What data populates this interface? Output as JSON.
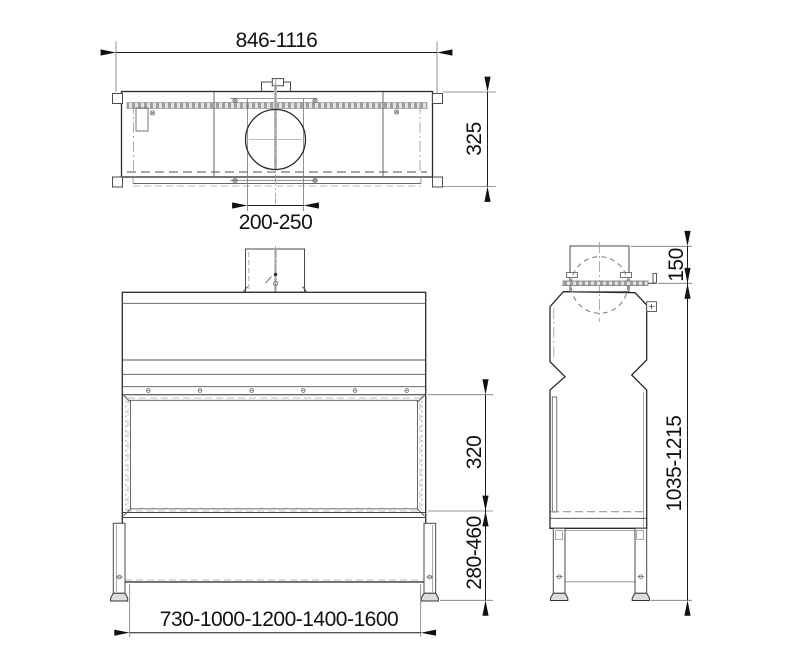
{
  "drawing": {
    "type": "technical-drawing",
    "colors": {
      "background": "#ffffff",
      "outline": "#2a2a2a",
      "dimension_text": "#111111",
      "hidden_lines": "#999999",
      "hatch": "#9f9f9f"
    },
    "views": {
      "top": {
        "dimensions": {
          "width": "846-1116",
          "depth": "325",
          "duct_diameter": "200-250"
        }
      },
      "front": {
        "dimensions": {
          "opening_height": "320",
          "base_height": "280-460",
          "available_widths": "730-1000-1200-1400-1600"
        }
      },
      "side": {
        "dimensions": {
          "flue_collar_height": "150",
          "overall_height": "1035-1215"
        }
      }
    }
  }
}
